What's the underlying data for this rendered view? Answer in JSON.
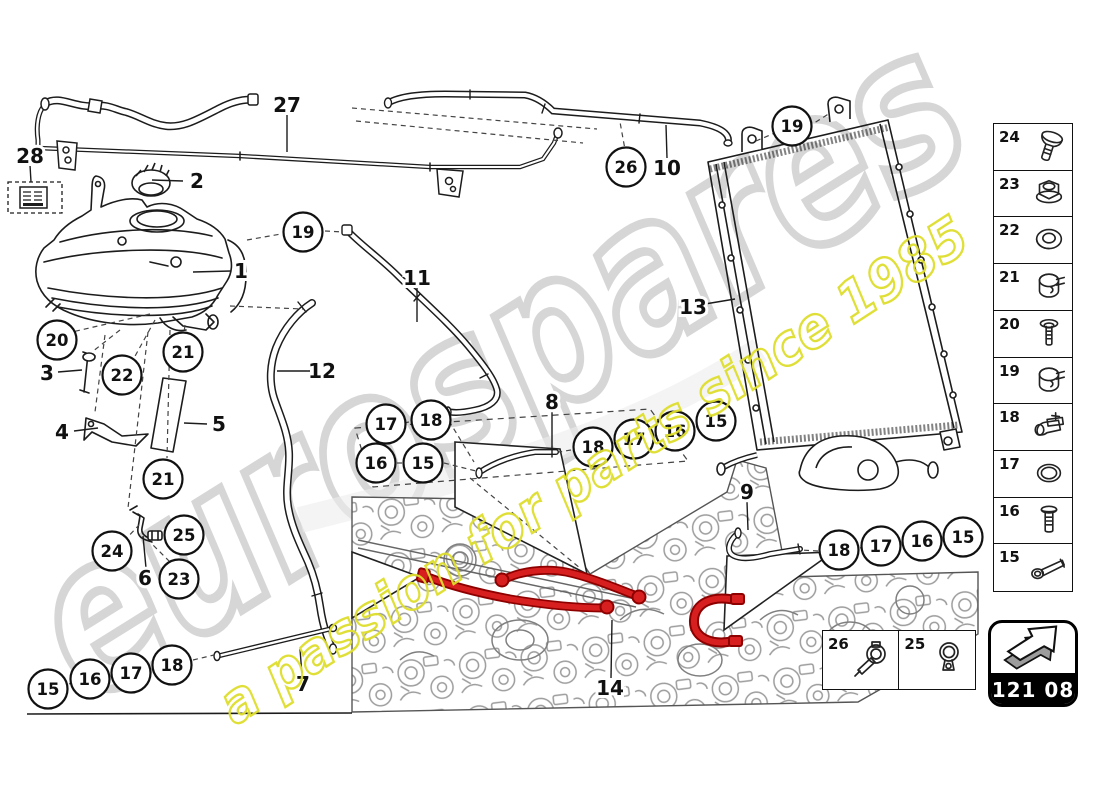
{
  "watermark": {
    "brand": "eurospares",
    "tagline": "a passion for parts since 1985",
    "brand_color": "#cdcdcd",
    "tagline_color": "#dede2e"
  },
  "badge": {
    "code": "121 08",
    "icon": "arrow-3d"
  },
  "sidebar": {
    "items": [
      {
        "number": "24",
        "icon": "dome-screw"
      },
      {
        "number": "23",
        "icon": "flange-nut"
      },
      {
        "number": "22",
        "icon": "grommet"
      },
      {
        "number": "21",
        "icon": "hose-clamp"
      },
      {
        "number": "20",
        "icon": "washer-screw"
      },
      {
        "number": "19",
        "icon": "hose-clamp"
      },
      {
        "number": "18",
        "icon": "pipe-clip"
      },
      {
        "number": "17",
        "icon": "o-ring"
      },
      {
        "number": "16",
        "icon": "stud-bolt"
      },
      {
        "number": "15",
        "icon": "long-screw"
      }
    ]
  },
  "inset": {
    "items": [
      {
        "number": "26",
        "icon": "clamp-screwdriver"
      },
      {
        "number": "25",
        "icon": "ring-clamp"
      }
    ]
  },
  "callouts": {
    "circled": [
      {
        "label": "19",
        "x": 303,
        "y": 232
      },
      {
        "label": "20",
        "x": 57,
        "y": 340
      },
      {
        "label": "21",
        "x": 183,
        "y": 352
      },
      {
        "label": "22",
        "x": 122,
        "y": 375
      },
      {
        "label": "21",
        "x": 163,
        "y": 479
      },
      {
        "label": "24",
        "x": 112,
        "y": 551
      },
      {
        "label": "25",
        "x": 184,
        "y": 535
      },
      {
        "label": "23",
        "x": 179,
        "y": 579
      },
      {
        "label": "26",
        "x": 626,
        "y": 167
      },
      {
        "label": "19",
        "x": 792,
        "y": 126
      },
      {
        "label": "17",
        "x": 386,
        "y": 424
      },
      {
        "label": "18",
        "x": 431,
        "y": 420
      },
      {
        "label": "16",
        "x": 376,
        "y": 463
      },
      {
        "label": "15",
        "x": 423,
        "y": 463
      },
      {
        "label": "18",
        "x": 593,
        "y": 447
      },
      {
        "label": "17",
        "x": 634,
        "y": 439
      },
      {
        "label": "16",
        "x": 675,
        "y": 431
      },
      {
        "label": "15",
        "x": 716,
        "y": 421
      },
      {
        "label": "18",
        "x": 839,
        "y": 550
      },
      {
        "label": "17",
        "x": 881,
        "y": 546
      },
      {
        "label": "16",
        "x": 922,
        "y": 541
      },
      {
        "label": "15",
        "x": 963,
        "y": 537
      },
      {
        "label": "15",
        "x": 48,
        "y": 689
      },
      {
        "label": "16",
        "x": 90,
        "y": 679
      },
      {
        "label": "17",
        "x": 131,
        "y": 673
      },
      {
        "label": "18",
        "x": 172,
        "y": 665
      }
    ],
    "plain": [
      {
        "label": "28",
        "x": 30,
        "y": 156
      },
      {
        "label": "2",
        "x": 197,
        "y": 181
      },
      {
        "label": "27",
        "x": 287,
        "y": 105
      },
      {
        "label": "1",
        "x": 241,
        "y": 271
      },
      {
        "label": "3",
        "x": 47,
        "y": 373
      },
      {
        "label": "4",
        "x": 62,
        "y": 432
      },
      {
        "label": "5",
        "x": 219,
        "y": 424
      },
      {
        "label": "6",
        "x": 145,
        "y": 578
      },
      {
        "label": "11",
        "x": 417,
        "y": 278
      },
      {
        "label": "12",
        "x": 322,
        "y": 371
      },
      {
        "label": "10",
        "x": 667,
        "y": 168
      },
      {
        "label": "13",
        "x": 693,
        "y": 307
      },
      {
        "label": "8",
        "x": 552,
        "y": 402
      },
      {
        "label": "9",
        "x": 747,
        "y": 492
      },
      {
        "label": "7",
        "x": 303,
        "y": 684
      },
      {
        "label": "14",
        "x": 610,
        "y": 688
      }
    ]
  },
  "colors": {
    "line": "#1c1c1c",
    "engine": "#999999",
    "highlight": "#d81f1f",
    "highlight_dark": "#8e0000"
  }
}
